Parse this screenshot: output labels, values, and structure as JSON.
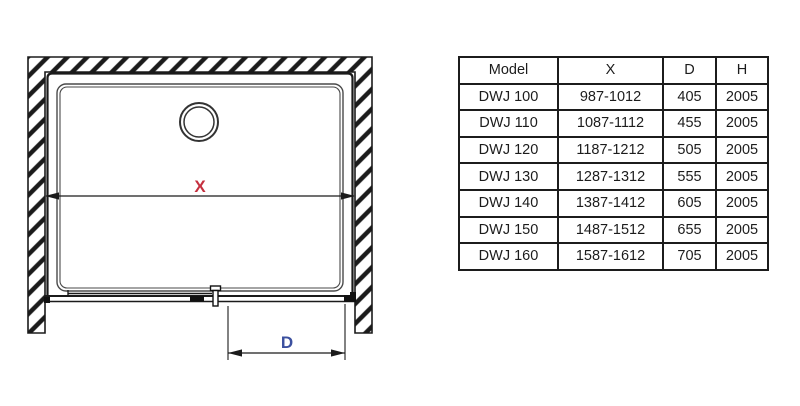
{
  "diagram": {
    "labels": {
      "width_dimension": "X",
      "entry_dimension": "D"
    },
    "colors": {
      "width_dimension_label": "#c5303f",
      "entry_dimension_label": "#3c509f",
      "line": "#1b1b1b"
    }
  },
  "table": {
    "headers": [
      "Model",
      "X",
      "D",
      "H"
    ],
    "rows": [
      [
        "DWJ 100",
        "987-1012",
        "405",
        "2005"
      ],
      [
        "DWJ 110",
        "1087-1112",
        "455",
        "2005"
      ],
      [
        "DWJ 120",
        "1187-1212",
        "505",
        "2005"
      ],
      [
        "DWJ 130",
        "1287-1312",
        "555",
        "2005"
      ],
      [
        "DWJ 140",
        "1387-1412",
        "605",
        "2005"
      ],
      [
        "DWJ 150",
        "1487-1512",
        "655",
        "2005"
      ],
      [
        "DWJ 160",
        "1587-1612",
        "705",
        "2005"
      ]
    ]
  }
}
